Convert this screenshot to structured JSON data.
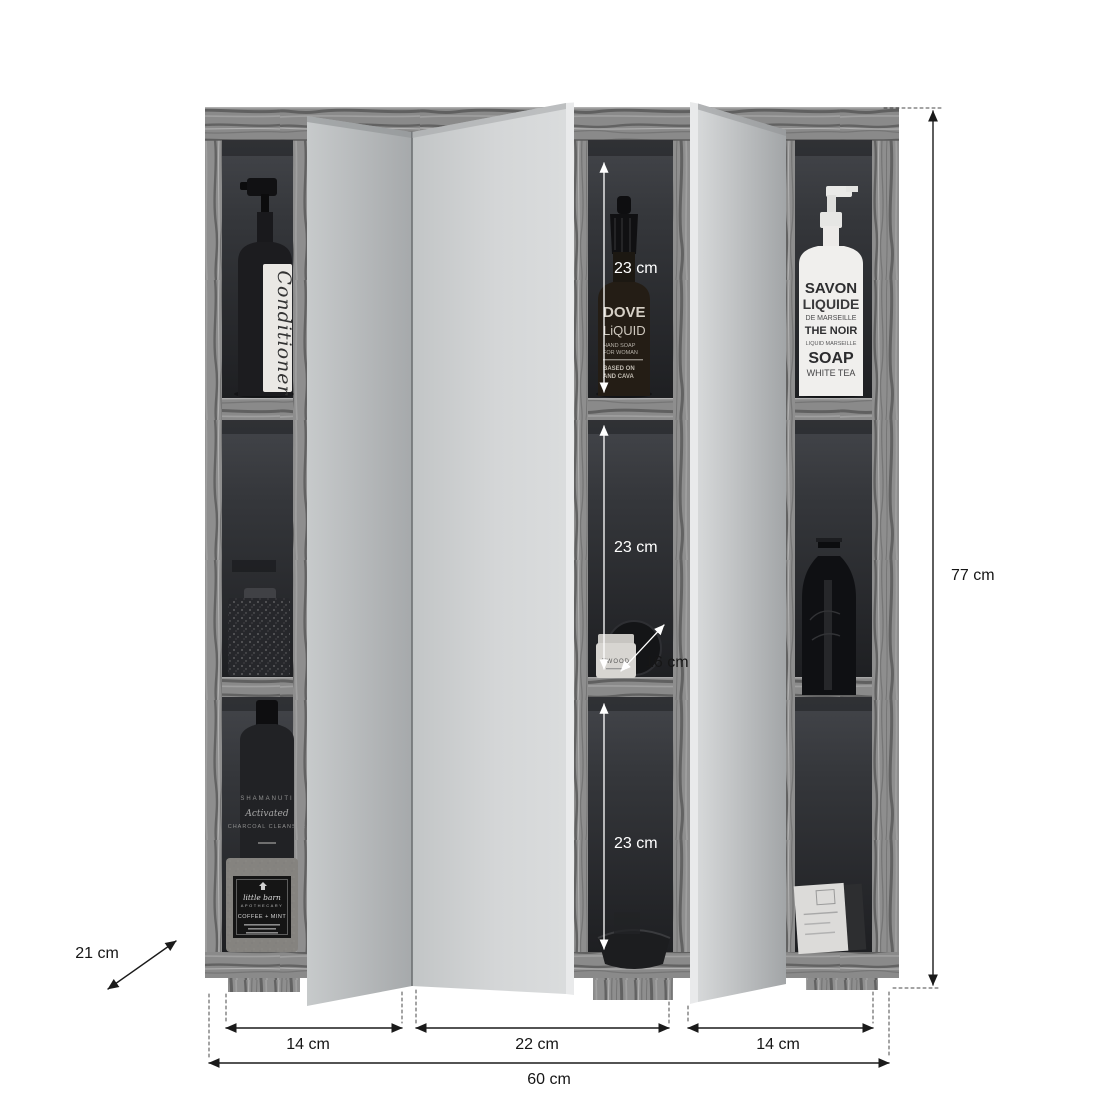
{
  "image_type": "product dimension diagram",
  "product": "three-section mirrored bathroom wall cabinet with open bi-fold doors",
  "dimensions": {
    "total_height": "77 cm",
    "total_width": "60 cm",
    "left_door_width": "14 cm",
    "center_door_width": "22 cm",
    "right_door_width": "14 cm",
    "top_shelf_height": "23 cm",
    "middle_shelf_height": "23 cm",
    "bottom_shelf_height": "23 cm",
    "shelf_depth": "16 cm",
    "cabinet_depth": "21 cm"
  },
  "products": {
    "conditioner_bottle": {
      "label": "Conditioner"
    },
    "dove_bottle": {
      "name": "DOVE",
      "type": "LiQUID",
      "line3": "HAND SOAP",
      "line4": "FOR WOMAN",
      "line5": "BASED ON",
      "line6": "AND CAVA"
    },
    "savon_bottle": {
      "line1": "SAVON",
      "line2": "LIQUIDE",
      "line3": "DE MARSEILLE",
      "line4": "THE NOIR",
      "line5": "LIQUID MARSEILLE",
      "line6": "SOAP",
      "line7": "WHITE TEA"
    },
    "charcoal_bottle": {
      "line1": "SHAMANUTI",
      "line2": "Activated",
      "line3": "CHARCOAL CLEANSER"
    },
    "scrub_jar": {
      "line1": "little barn",
      "line2": "APOTHECARY",
      "line3": "COFFEE + MINT"
    },
    "small_jar": {
      "label": "TWOOD"
    }
  },
  "colors": {
    "background": "#ffffff",
    "dimension_line": "#1a1a1a",
    "interior_arrow": "#ffffff",
    "wood_gray": "#8e8e8e",
    "wood_streak": "#4a4a4a",
    "interior_dark": "#26282b",
    "mirror_gray": "#c9cccd",
    "mirror_edge": "#e9eaeb"
  }
}
